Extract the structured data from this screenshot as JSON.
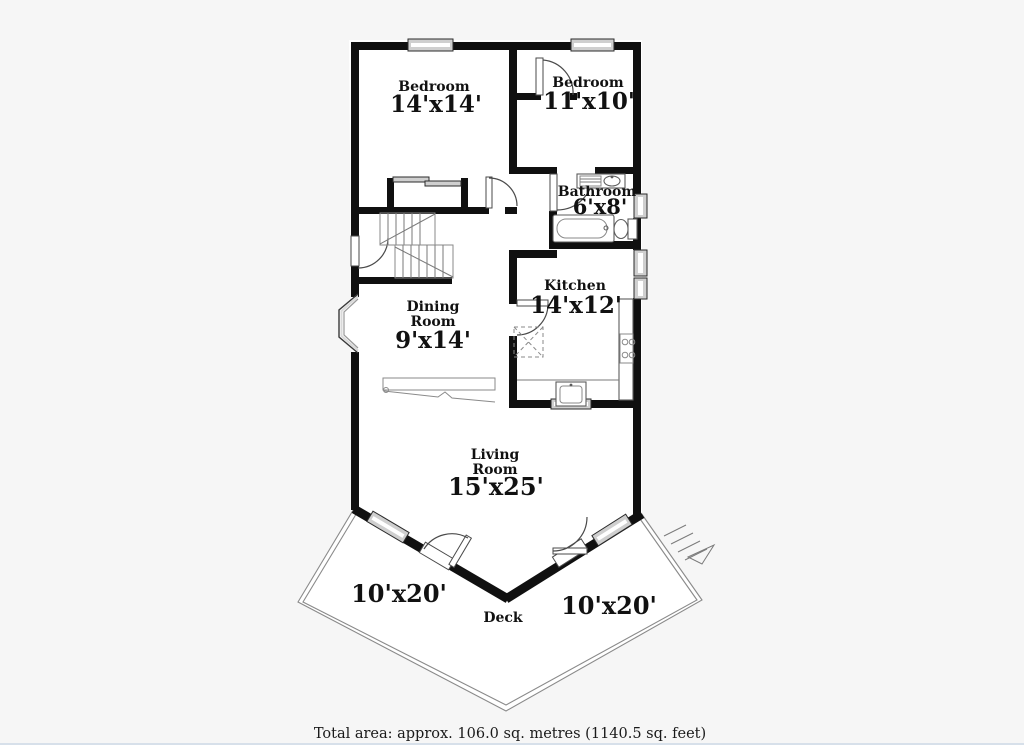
{
  "floorplan": {
    "rooms": {
      "bedroom1": {
        "name": "Bedroom",
        "size": "14'x14'"
      },
      "bedroom2": {
        "name": "Bedroom",
        "size": "11'x10'"
      },
      "bathroom": {
        "name": "Bathroom",
        "size": "6'x8'"
      },
      "kitchen": {
        "name": "Kitchen",
        "size": "14'x12'"
      },
      "dining": {
        "name_line1": "Dining",
        "name_line2": "Room",
        "size": "9'x14'"
      },
      "living": {
        "name_line1": "Living",
        "name_line2": "Room",
        "size": "15'x25'"
      }
    },
    "deck": {
      "label": "Deck",
      "left_size": "10'x20'",
      "right_size": "10'x20'"
    },
    "footer": {
      "total_area": "Total area: approx. 106.0 sq. metres (1140.5 sq. feet)"
    },
    "colors": {
      "wall": "#101010",
      "window_fill": "#cfcfcf",
      "door_line": "#4a4a4a",
      "background": "#f6f6f6"
    }
  }
}
